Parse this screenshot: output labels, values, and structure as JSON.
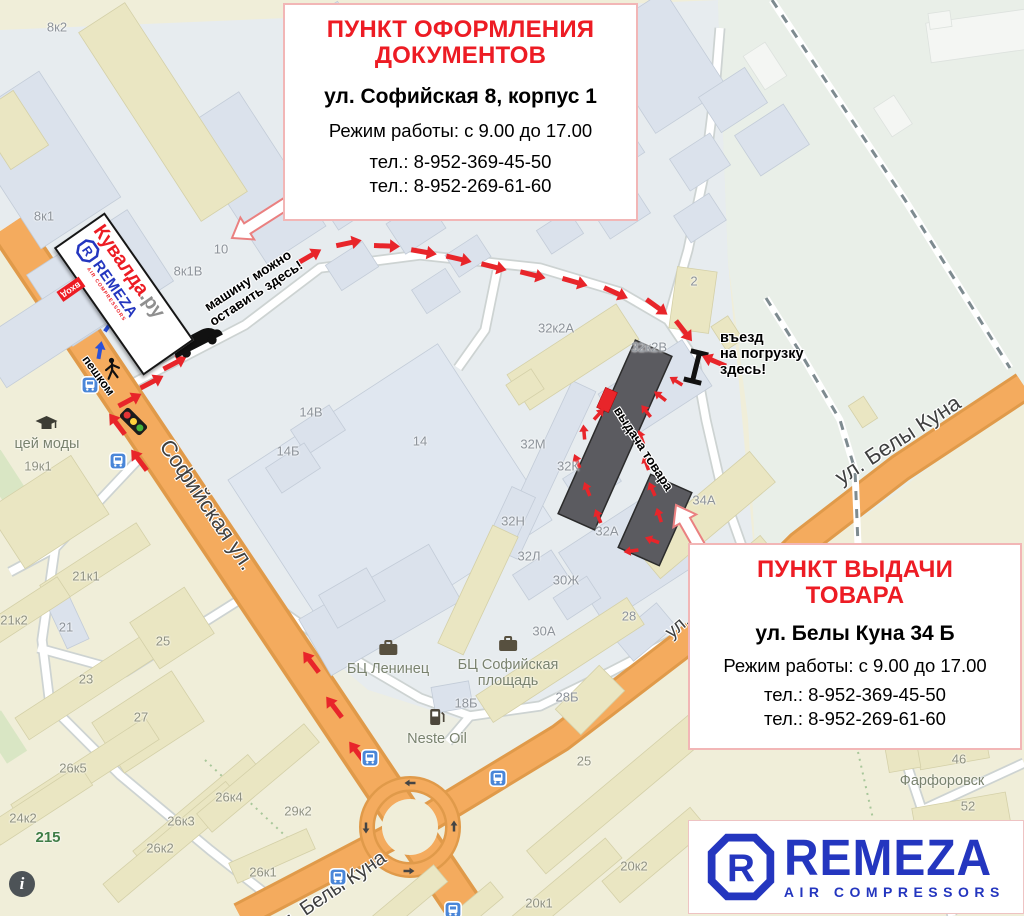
{
  "colors": {
    "title_red": "#ed1c24",
    "route_red": "#e8252a",
    "walk_blue": "#2b50d8",
    "brand_blue": "#2436bf",
    "road_orange": "#f4ab5e",
    "box_border": "#f2b6b6",
    "suffix_gray": "#8f8f8f"
  },
  "boxes": {
    "documents": {
      "title": [
        "ПУНКТ ОФОРМЛЕНИЯ",
        "ДОКУМЕНТОВ"
      ],
      "address": "ул. Софийская 8, корпус 1",
      "hours": "Режим работы: с 9.00 до 17.00",
      "phones": [
        "тел.: 8-952-369-45-50",
        "тел.: 8-952-269-61-60"
      ]
    },
    "pickup": {
      "title": [
        "ПУНКТ ВЫДАЧИ",
        "ТОВАРА"
      ],
      "address": "ул. Белы Куна 34 Б",
      "hours": "Режим работы: с 9.00 до 17.00",
      "phones": [
        "тел.: 8-952-369-45-50",
        "тел.: 8-952-269-61-60"
      ]
    }
  },
  "kuvalda_sign": {
    "brand": "Кувалда",
    "brand_suffix": ".ру",
    "remeza": "REMEZA",
    "remeza_sub": "AIR COMPRESSORS",
    "entrance": "вход"
  },
  "remeza_card": {
    "name": "REMEZA",
    "subtitle": "AIR COMPRESSORS"
  },
  "notes": {
    "parking": [
      "машину можно",
      "оставить здесь!"
    ],
    "loading": [
      "въезд",
      "на погрузку",
      "здесь!"
    ],
    "pickup_building": "выдача товара",
    "walking": "пешком"
  },
  "map": {
    "streets": [
      {
        "name": "Софийская ул.",
        "x": 207,
        "y": 505,
        "rot": 56,
        "size": 22
      },
      {
        "name": "ул. Белы Куна",
        "x": 898,
        "y": 440,
        "rot": -33,
        "size": 22
      },
      {
        "name": "ул. Белы Куна",
        "x": 330,
        "y": 893,
        "rot": -34,
        "size": 20
      },
      {
        "name": "ул.",
        "x": 678,
        "y": 627,
        "rot": -40,
        "size": 19
      }
    ],
    "building_labels": [
      {
        "t": "8к2",
        "x": 57,
        "y": 27
      },
      {
        "t": "8к1",
        "x": 44,
        "y": 216
      },
      {
        "t": "8к1В",
        "x": 188,
        "y": 271
      },
      {
        "t": "10",
        "x": 221,
        "y": 249
      },
      {
        "t": "14В",
        "x": 311,
        "y": 412
      },
      {
        "t": "14Б",
        "x": 288,
        "y": 451
      },
      {
        "t": "14",
        "x": 420,
        "y": 441
      },
      {
        "t": "32к2А",
        "x": 556,
        "y": 328
      },
      {
        "t": "32к2В",
        "x": 649,
        "y": 347
      },
      {
        "t": "32М",
        "x": 533,
        "y": 444
      },
      {
        "t": "32К",
        "x": 568,
        "y": 466
      },
      {
        "t": "32Н",
        "x": 513,
        "y": 521
      },
      {
        "t": "32Л",
        "x": 529,
        "y": 556
      },
      {
        "t": "32А",
        "x": 607,
        "y": 531
      },
      {
        "t": "30Ж",
        "x": 566,
        "y": 580
      },
      {
        "t": "30А",
        "x": 544,
        "y": 631
      },
      {
        "t": "28",
        "x": 629,
        "y": 616
      },
      {
        "t": "28Б",
        "x": 567,
        "y": 697
      },
      {
        "t": "18Б",
        "x": 466,
        "y": 703
      },
      {
        "t": "2",
        "x": 694,
        "y": 281
      },
      {
        "t": "34А",
        "x": 704,
        "y": 500
      },
      {
        "t": "21",
        "x": 66,
        "y": 627
      },
      {
        "t": "19к1",
        "x": 38,
        "y": 466,
        "z": "y"
      },
      {
        "t": "21к1",
        "x": 86,
        "y": 576,
        "z": "y"
      },
      {
        "t": "21к2",
        "x": 14,
        "y": 620,
        "z": "y"
      },
      {
        "t": "23",
        "x": 86,
        "y": 679,
        "z": "y"
      },
      {
        "t": "25",
        "x": 163,
        "y": 641,
        "z": "y"
      },
      {
        "t": "27",
        "x": 141,
        "y": 717,
        "z": "y"
      },
      {
        "t": "26к5",
        "x": 73,
        "y": 768,
        "z": "y"
      },
      {
        "t": "24к2",
        "x": 23,
        "y": 818,
        "z": "y"
      },
      {
        "t": "26к3",
        "x": 181,
        "y": 821,
        "z": "y"
      },
      {
        "t": "26к2",
        "x": 160,
        "y": 848,
        "z": "y"
      },
      {
        "t": "26к4",
        "x": 229,
        "y": 797,
        "z": "y"
      },
      {
        "t": "26к1",
        "x": 263,
        "y": 872,
        "z": "y"
      },
      {
        "t": "29к2",
        "x": 298,
        "y": 811,
        "z": "y"
      },
      {
        "t": "25",
        "x": 584,
        "y": 761,
        "z": "y"
      },
      {
        "t": "20к2",
        "x": 634,
        "y": 866,
        "z": "y"
      },
      {
        "t": "20к1",
        "x": 539,
        "y": 903,
        "z": "y"
      },
      {
        "t": "46",
        "x": 959,
        "y": 759,
        "z": "y"
      },
      {
        "t": "52",
        "x": 968,
        "y": 806,
        "z": "y"
      }
    ],
    "pois": [
      {
        "lines": [
          "БЦ Ленинец"
        ],
        "x": 388,
        "y": 640,
        "icon": "briefcase"
      },
      {
        "lines": [
          "БЦ Софийская",
          "площадь"
        ],
        "x": 508,
        "y": 636,
        "icon": "briefcase"
      },
      {
        "lines": [
          "Neste Oil"
        ],
        "x": 437,
        "y": 708,
        "icon": "fuel"
      },
      {
        "lines": [
          "цей моды"
        ],
        "x": 47,
        "y": 416,
        "icon": "museum"
      },
      {
        "lines": [
          "Фарфоровск"
        ],
        "x": 942,
        "y": 774
      },
      {
        "lines": [
          "215"
        ],
        "x": 48,
        "y": 830,
        "green": true
      }
    ],
    "transport_stops": [
      [
        90,
        385
      ],
      [
        118,
        461
      ],
      [
        370,
        758
      ],
      [
        498,
        778
      ],
      [
        338,
        877
      ],
      [
        453,
        910
      ]
    ],
    "route": {
      "approach": [
        [
          130,
          400,
          -28
        ],
        [
          152,
          382,
          -28
        ],
        [
          175,
          363,
          -28
        ],
        [
          310,
          256,
          -30
        ],
        [
          349,
          243,
          -12
        ],
        [
          387,
          246,
          2
        ],
        [
          424,
          252,
          10
        ],
        [
          459,
          259,
          13
        ],
        [
          494,
          267,
          14
        ],
        [
          533,
          275,
          14
        ],
        [
          575,
          282,
          16
        ],
        [
          616,
          293,
          24
        ],
        [
          657,
          307,
          36
        ],
        [
          684,
          331,
          52
        ],
        [
          714,
          361,
          203
        ]
      ],
      "street": [
        [
          117,
          424,
          -127
        ],
        [
          139,
          460,
          -127
        ],
        [
          311,
          662,
          -127
        ],
        [
          334,
          707,
          -127
        ],
        [
          357,
          752,
          -127
        ]
      ],
      "yard": [
        [
          676,
          381,
          212
        ],
        [
          660,
          396,
          218
        ],
        [
          646,
          411,
          232
        ],
        [
          641,
          437,
          250
        ],
        [
          646,
          463,
          250
        ],
        [
          652,
          489,
          246
        ],
        [
          659,
          515,
          252
        ],
        [
          652,
          540,
          200
        ],
        [
          631,
          551,
          172
        ],
        [
          598,
          516,
          -112
        ],
        [
          587,
          489,
          -112
        ],
        [
          577,
          461,
          -112
        ],
        [
          584,
          432,
          -95
        ],
        [
          599,
          414,
          -48
        ]
      ],
      "walk": [
        [
          100,
          350,
          -80
        ],
        [
          110,
          324,
          -55
        ]
      ],
      "roundabout": [
        [
          410,
          783,
          180
        ],
        [
          366,
          828,
          90
        ],
        [
          454,
          826,
          -90
        ],
        [
          409,
          871,
          0
        ]
      ]
    }
  }
}
